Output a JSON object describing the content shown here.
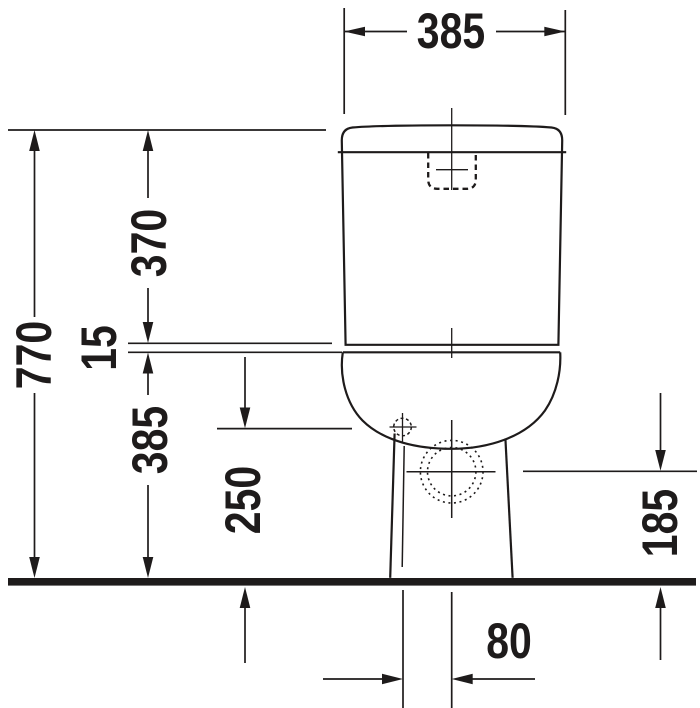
{
  "drawing": {
    "type": "technical-dimension-drawing",
    "subject": "toilet-front-elevation",
    "background": "#ffffff",
    "line_color": "#1e1b1b",
    "dimensions": {
      "width_top": "385",
      "height_total": "770",
      "tank_height": "370",
      "seat_gap": "15",
      "bowl_height": "385",
      "fixing_height": "250",
      "outlet_height": "185",
      "outlet_offset": "80"
    }
  }
}
